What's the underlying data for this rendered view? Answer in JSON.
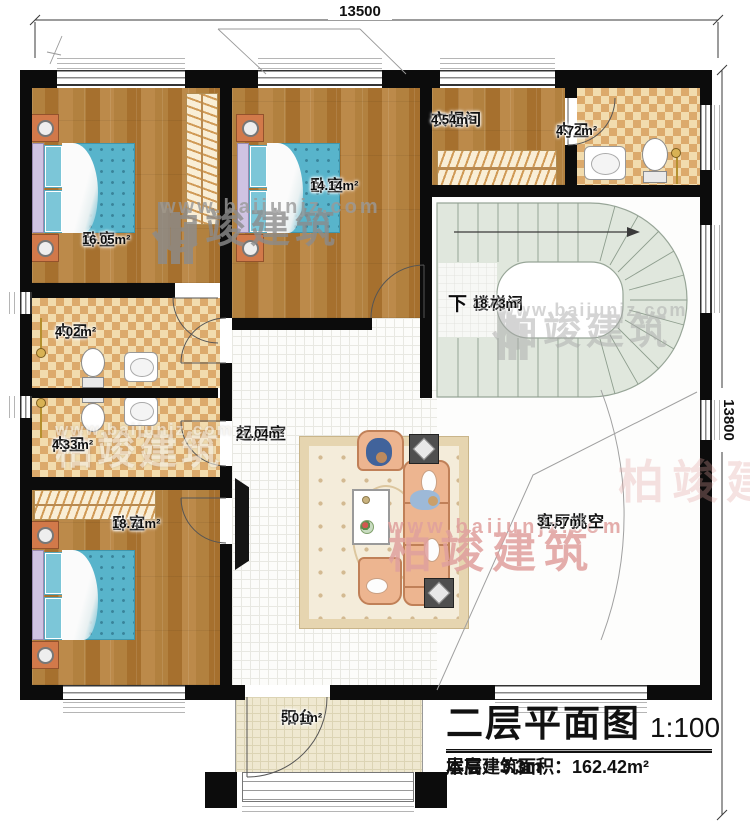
{
  "dims": {
    "top": "13500",
    "right": "13800"
  },
  "watermark": {
    "brand": "柏竣建筑",
    "url": "www.baijunjz.com"
  },
  "rooms": {
    "bedroom1": {
      "name": "卧室",
      "area": "16.05m²"
    },
    "bedroom2": {
      "name": "卧室",
      "area": "14.14m²"
    },
    "cloakroom": {
      "name": "衣帽间",
      "area": "4.54m²"
    },
    "bath_top": {
      "name": "内卫",
      "area": "4.72m²"
    },
    "stairwell": {
      "name": "楼梯间",
      "area": "18.73m²",
      "direction": "下"
    },
    "bath_mid1": {
      "name": "内卫",
      "area": "4.02m²"
    },
    "bath_mid2": {
      "name": "内卫",
      "area": "4.33m²"
    },
    "living": {
      "name": "起居室",
      "area": "27.04m²"
    },
    "void": {
      "name": "客厅挑空",
      "area": "31.57m²"
    },
    "bedroom3": {
      "name": "卧室",
      "area": "18.71m²"
    },
    "balcony": {
      "name": "阳台",
      "area": "5.01m²"
    }
  },
  "title_block": {
    "title": "二层平面图",
    "scale": "1:100",
    "area_label": "本层建筑面积：",
    "area_value": "162.42m²",
    "floor_height_label": "层高：",
    "floor_height_value": "3.3m"
  },
  "colors": {
    "wall": "#0c0c0c",
    "wood_floor": "#b1803f",
    "checker_light": "#f2dcae",
    "checker_dark": "#dcaa6c",
    "bed_blue": "#58b4cb",
    "sofa_peach": "#edb590",
    "stair_tread": "#e0e7dd",
    "watermark_gray": "#8c8c8c",
    "watermark_red": "#e0a09e"
  }
}
